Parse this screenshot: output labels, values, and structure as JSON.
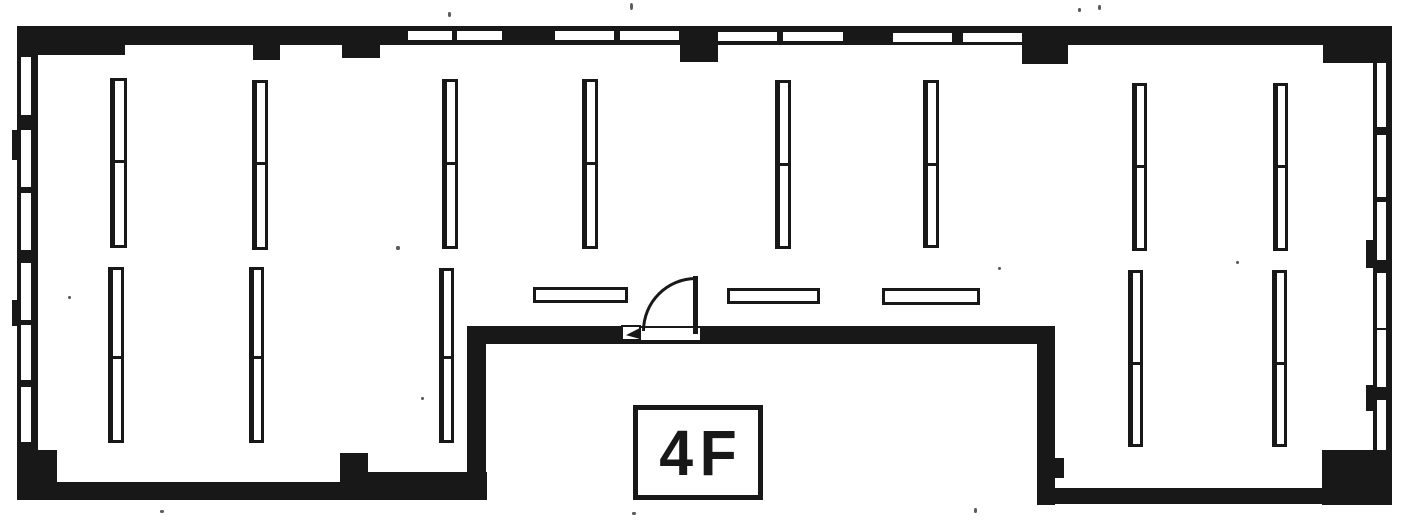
{
  "page": {
    "title": "Floor plan",
    "floor_label": "4F"
  },
  "colors": {
    "ink": "#181818",
    "paper": "#ffffff"
  },
  "plan": {
    "width": 1413,
    "height": 526,
    "label_box": {
      "text": "4F",
      "rect": [
        633,
        405,
        130,
        95
      ]
    },
    "groups": [
      {
        "name": "wall-segment",
        "class": "ink",
        "rects": [
          [
            17,
            26,
            1375,
            19
          ],
          [
            17,
            26,
            21,
            474
          ],
          [
            1373,
            30,
            19,
            475
          ],
          [
            17,
            26,
            108,
            29
          ],
          [
            1323,
            26,
            69,
            37
          ],
          [
            17,
            450,
            40,
            50
          ],
          [
            1322,
            450,
            70,
            55
          ],
          [
            17,
            482,
            470,
            18
          ],
          [
            368,
            472,
            119,
            28
          ],
          [
            340,
            453,
            28,
            47
          ],
          [
            467,
            328,
            19,
            172
          ],
          [
            467,
            326,
            588,
            18
          ],
          [
            1037,
            330,
            18,
            175
          ],
          [
            1050,
            458,
            14,
            20
          ],
          [
            1037,
            488,
            355,
            16
          ]
        ]
      },
      {
        "name": "column-pillar",
        "class": "ink",
        "rects": [
          [
            253,
            45,
            27,
            15
          ],
          [
            342,
            45,
            38,
            13
          ],
          [
            680,
            45,
            38,
            17
          ],
          [
            1022,
            45,
            46,
            19
          ]
        ]
      },
      {
        "name": "wall-blob",
        "class": "ink",
        "rects": [
          [
            1366,
            240,
            8,
            28
          ],
          [
            1366,
            385,
            8,
            26
          ],
          [
            12,
            130,
            6,
            30
          ],
          [
            12,
            300,
            6,
            26
          ]
        ]
      },
      {
        "name": "window-slot",
        "class": "paper-slot",
        "rects": [
          [
            408,
            31,
            44,
            9
          ],
          [
            457,
            31,
            45,
            9
          ],
          [
            555,
            31,
            59,
            9
          ],
          [
            620,
            31,
            59,
            9
          ],
          [
            718,
            32,
            59,
            9
          ],
          [
            783,
            32,
            60,
            9
          ],
          [
            893,
            33,
            59,
            9
          ],
          [
            963,
            33,
            59,
            9
          ],
          [
            21,
            57,
            10,
            58
          ],
          [
            21,
            130,
            10,
            57
          ],
          [
            21,
            193,
            10,
            57
          ],
          [
            21,
            263,
            10,
            57
          ],
          [
            21,
            325,
            10,
            55
          ],
          [
            21,
            387,
            10,
            55
          ],
          [
            1377,
            63,
            9,
            64
          ],
          [
            1377,
            135,
            9,
            62
          ],
          [
            1377,
            202,
            9,
            58
          ],
          [
            1377,
            273,
            9,
            55
          ],
          [
            1377,
            330,
            9,
            57
          ],
          [
            1377,
            400,
            9,
            50
          ]
        ]
      },
      {
        "name": "scan-speckle",
        "class": "speck",
        "rects": [
          [
            448,
            12,
            3,
            5
          ],
          [
            630,
            3,
            3,
            7
          ],
          [
            1078,
            8,
            3,
            4
          ],
          [
            1098,
            5,
            3,
            5
          ],
          [
            396,
            246,
            4,
            4
          ],
          [
            449,
            175,
            3,
            3
          ],
          [
            1236,
            261,
            3,
            3
          ],
          [
            160,
            510,
            4,
            3
          ],
          [
            632,
            512,
            4,
            3
          ],
          [
            974,
            508,
            3,
            5
          ],
          [
            421,
            397,
            3,
            3
          ],
          [
            998,
            267,
            3,
            3
          ],
          [
            68,
            296,
            3,
            3
          ]
        ]
      }
    ],
    "window_bars": [
      [
        110,
        78,
        17,
        170,
        82
      ],
      [
        252,
        80,
        16,
        170,
        82
      ],
      [
        442,
        79,
        16,
        170,
        83
      ],
      [
        582,
        79,
        16,
        170,
        83
      ],
      [
        775,
        80,
        16,
        169,
        83
      ],
      [
        923,
        80,
        16,
        168,
        83
      ],
      [
        1132,
        83,
        15,
        168,
        82
      ],
      [
        1273,
        83,
        15,
        168,
        82
      ],
      [
        108,
        267,
        16,
        176,
        89
      ],
      [
        249,
        267,
        15,
        176,
        89
      ],
      [
        439,
        268,
        15,
        175,
        88
      ],
      [
        1128,
        270,
        15,
        177,
        92
      ],
      [
        1272,
        270,
        15,
        177,
        92
      ]
    ],
    "partition_bars": [
      [
        533,
        287,
        95,
        16
      ],
      [
        727,
        288,
        93,
        16
      ],
      [
        882,
        288,
        98,
        17
      ]
    ],
    "door": {
      "gap": [
        622,
        326,
        78,
        14
      ],
      "top_line": [
        622,
        326,
        78,
        2
      ],
      "bottom_line": [
        622,
        340,
        78,
        4
      ],
      "hinge": [
        621,
        325,
        20,
        16
      ],
      "wedge": [
        626,
        328,
        14,
        11
      ],
      "leaf": [
        693,
        276,
        5,
        58
      ],
      "arc": [
        642,
        277,
        54,
        54
      ]
    }
  }
}
